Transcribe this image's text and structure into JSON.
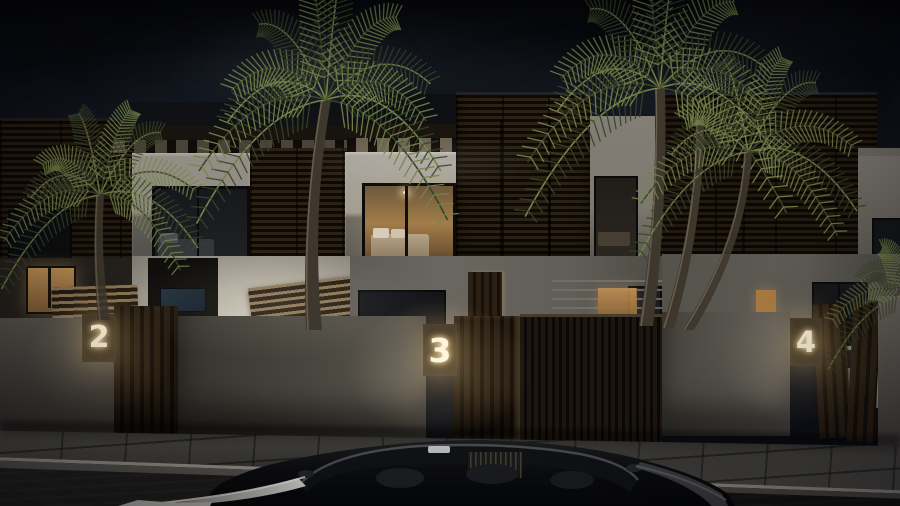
{
  "scene": {
    "description": "Night-time architectural render of a row of modern two-storey townhouses with dark timber louvre facades, illuminated unit number plaques on the perimeter wall, palm trees, a paved sidewalk and a black car parked in the street; a white car sits behind the open gate of unit 4",
    "units": [
      {
        "number": "2"
      },
      {
        "number": "3"
      },
      {
        "number": "4"
      }
    ],
    "palette": {
      "sky_top": "#07080c",
      "sky_horizon": "#171c24",
      "wall_lit": "#c7c1b5",
      "wall_shaded": "#57544e",
      "wood_dark": "#221a11",
      "window_warm": "#c89a5e",
      "number_glow": "#fff3d8",
      "palm_lit": "#76844b",
      "palm_dark": "#39422a",
      "trunk": "#3e372d",
      "pavement": "#4d4b46",
      "street": "#191817",
      "car_body": "#0a0b0c"
    }
  }
}
